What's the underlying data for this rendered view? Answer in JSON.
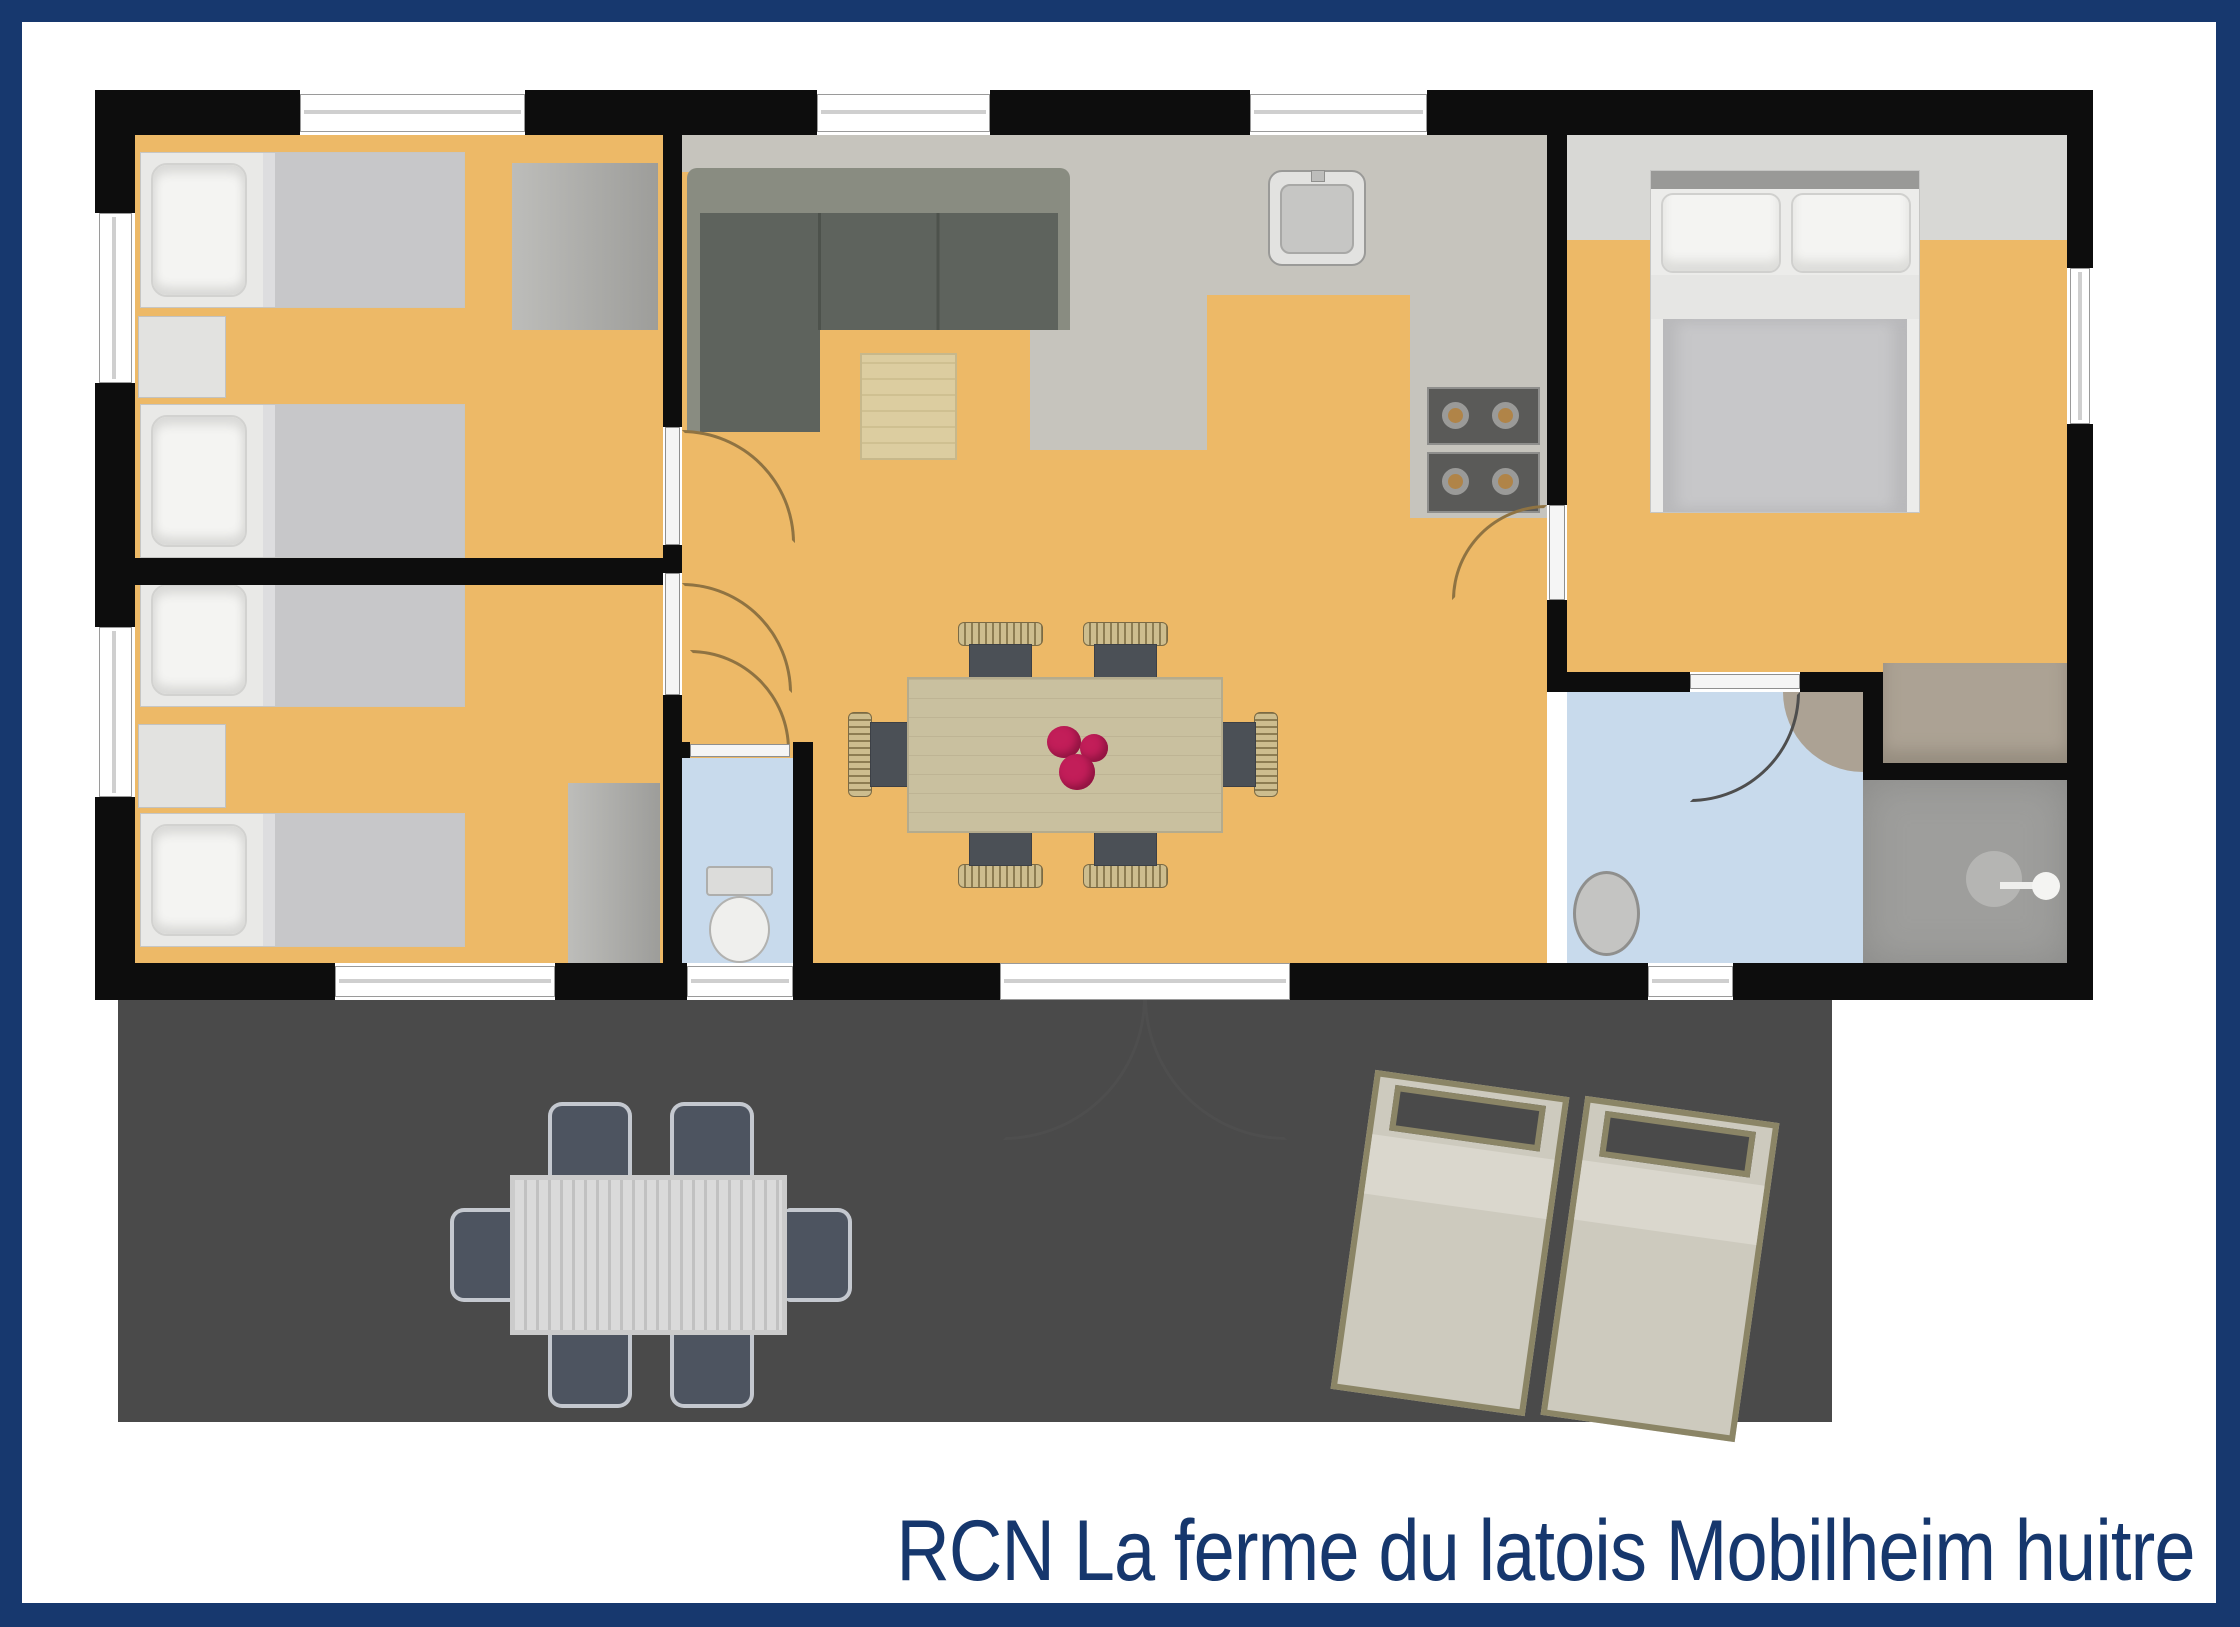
{
  "caption": {
    "text": "RCN La ferme du latois Mobilheim huitre"
  },
  "palette": {
    "border_navy": "#17386e",
    "caption_color": "#16376d",
    "wall": "#0d0d0d",
    "floor_orange": "#edb967",
    "floor_gray": "#c6c4bd",
    "floor_blue": "#c8daec",
    "terrace": "#4a4a4a",
    "sofa_dark": "#5e635d",
    "sofa_light": "#898c81",
    "table_wood": "#c9c09f",
    "coffee_table": "#dccda0",
    "chair_seat": "#4b5056",
    "flower": "#c21e59",
    "bed_blanket": "#c7c7c9",
    "bed_white": "#f4f4f2",
    "wardrobe_taupe": "#aca294",
    "shower_gray": "#9e9e9c",
    "lounger_frame": "#8b8566",
    "lounger_cushion": "#cdcabe",
    "outdoor_table": "#d6d6d6",
    "outdoor_chair": "#4d5460",
    "arc_tan": "#8f7342",
    "arc_dark": "#4e4e4e"
  }
}
